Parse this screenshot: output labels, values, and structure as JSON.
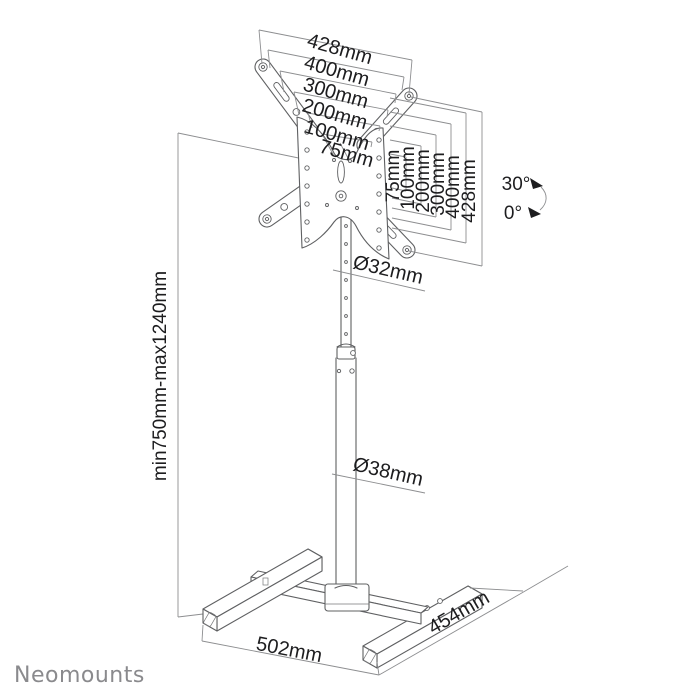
{
  "brand": {
    "name": "Neomounts"
  },
  "diagram_title": "TV floor stand dimensional drawing",
  "colors": {
    "product_line": "#5f6062",
    "dimension_line": "#8d8e90",
    "text": "#1d1d1f",
    "logo": "#8a8a8d"
  },
  "dimensions": {
    "top_widths": [
      "428mm",
      "400mm",
      "300mm",
      "200mm",
      "100mm",
      "75mm"
    ],
    "right_heights": [
      "75mm",
      "100mm",
      "200mm",
      "300mm",
      "400mm",
      "428mm"
    ],
    "height_range": "min750mm-max1240mm",
    "upper_pole_diameter": "Ø32mm",
    "lower_pole_diameter": "Ø38mm",
    "base_width": "502mm",
    "base_depth": "454mm"
  },
  "tilt": {
    "max": "30°",
    "min": "0°"
  }
}
